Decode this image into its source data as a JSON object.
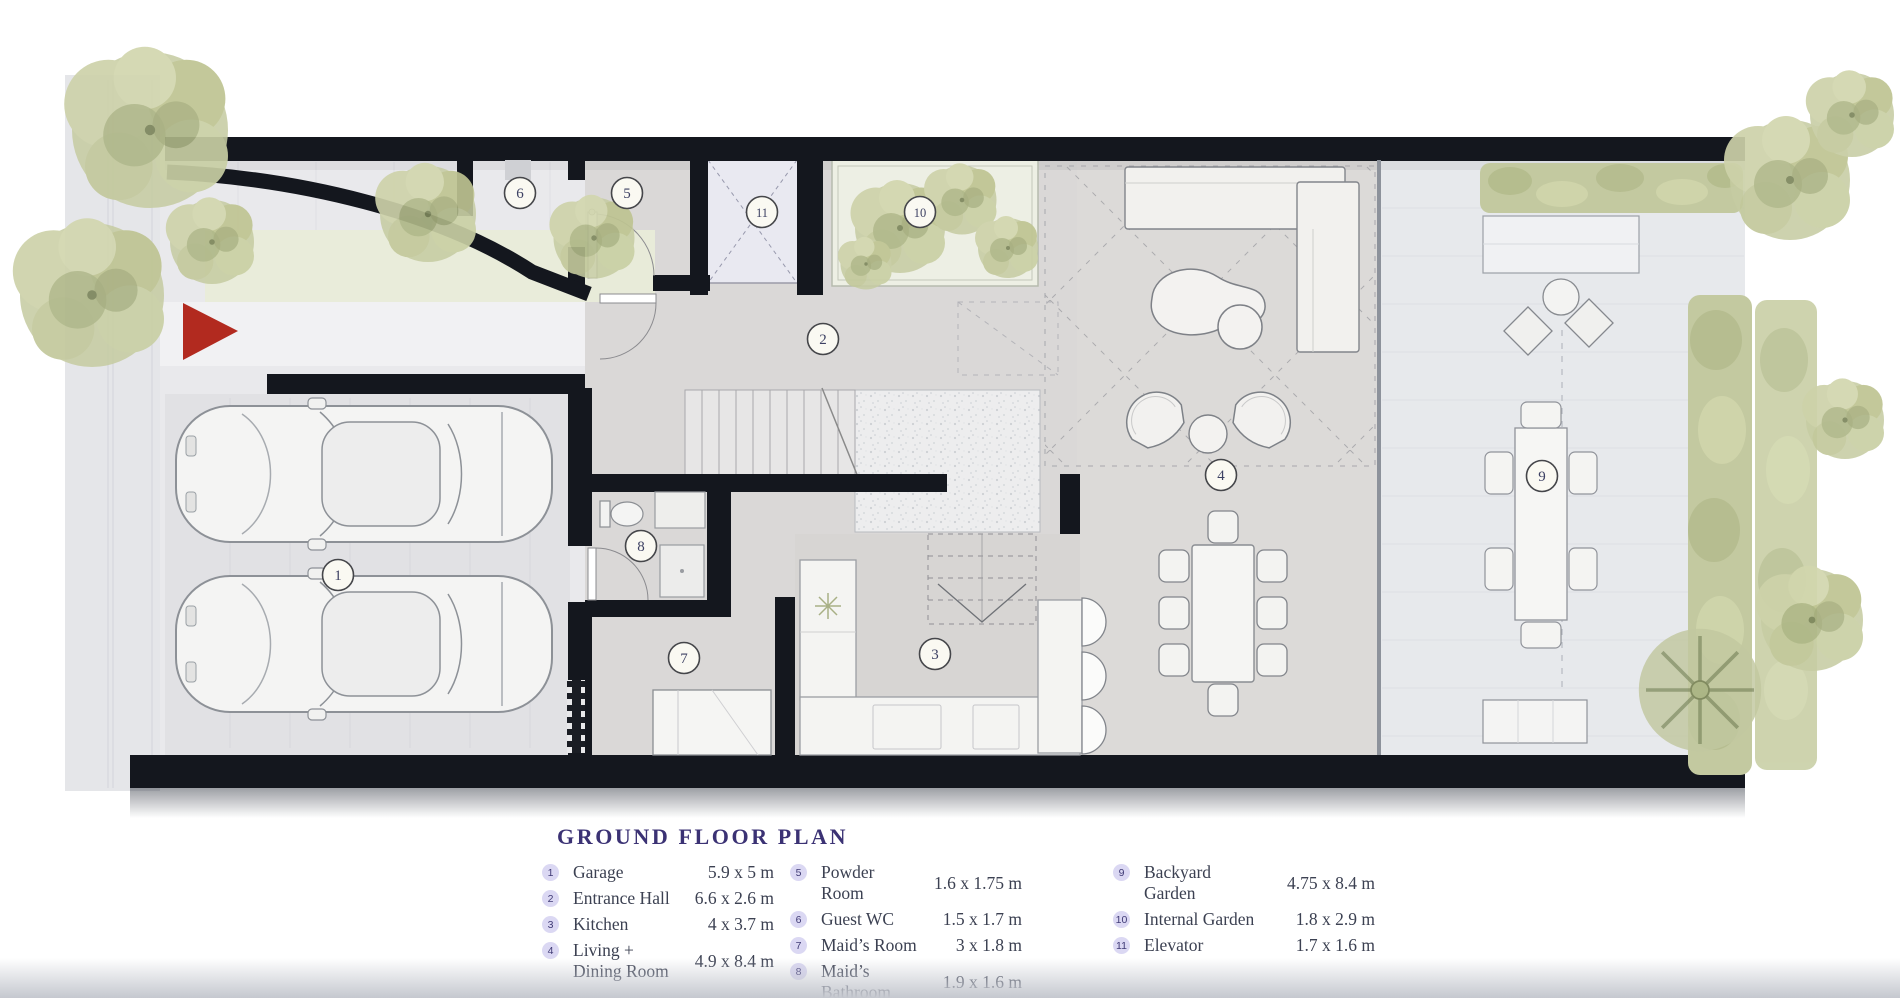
{
  "title": "GROUND FLOOR PLAN",
  "rooms": [
    {
      "num": "1",
      "name": "Garage",
      "dims": "5.9 x 5 m"
    },
    {
      "num": "2",
      "name": "Entrance Hall",
      "dims": "6.6 x 2.6 m"
    },
    {
      "num": "3",
      "name": "Kitchen",
      "dims": "4 x 3.7 m"
    },
    {
      "num": "4",
      "name": "Living + Dining Room",
      "dims": "4.9 x 8.4 m"
    },
    {
      "num": "5",
      "name": "Powder Room",
      "dims": "1.6 x 1.75 m"
    },
    {
      "num": "6",
      "name": "Guest WC",
      "dims": "1.5 x 1.7 m"
    },
    {
      "num": "7",
      "name": "Maid’s Room",
      "dims": "3 x 1.8 m"
    },
    {
      "num": "8",
      "name": "Maid’s Bathroom",
      "dims": "1.9 x 1.6 m"
    },
    {
      "num": "9",
      "name": "Backyard Garden",
      "dims": "4.75 x 8.4 m"
    },
    {
      "num": "10",
      "name": "Internal Garden",
      "dims": "1.8 x 2.9 m"
    },
    {
      "num": "11",
      "name": "Elevator",
      "dims": "1.7 x 1.6 m"
    }
  ],
  "colors": {
    "title_text": "#3b3274",
    "legend_text": "#3c4152",
    "legend_badge_bg": "#dbd8f3",
    "legend_badge_text": "#3f3a75",
    "plan_badge_bg": "#faf9f2",
    "wall": "#14171e",
    "entrance_arrow": "#b22a1f",
    "greenery": "#c6cba2",
    "floor_gray": "#dad8d7",
    "backyard_paving": "#e7e9ec"
  }
}
